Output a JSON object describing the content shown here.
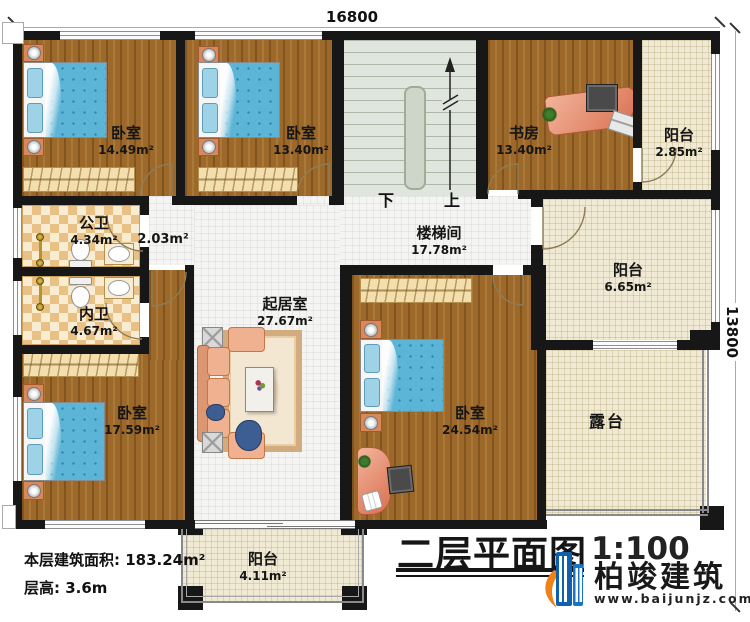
{
  "dimensions": {
    "top_width": "16800",
    "right_height": "13800"
  },
  "stairs": {
    "down": "下",
    "up": "上"
  },
  "rooms": {
    "bedroom_top_left": {
      "label": "卧室",
      "area": "14.49m²"
    },
    "bedroom_top_mid": {
      "label": "卧室",
      "area": "13.40m²"
    },
    "study": {
      "label": "书房",
      "area": "13.40m²"
    },
    "balcony_top_right": {
      "label": "阳台",
      "area": "2.85m²"
    },
    "public_bath": {
      "label": "公卫",
      "area": "4.34m²"
    },
    "hallway": {
      "area": "2.03m²"
    },
    "private_bath": {
      "label": "内卫",
      "area": "4.67m²"
    },
    "stairwell": {
      "label": "楼梯间",
      "area": "17.78m²"
    },
    "bedroom_bottom_left": {
      "label": "卧室",
      "area": "17.59m²"
    },
    "living_room": {
      "label": "起居室",
      "area": "27.67m²"
    },
    "bedroom_bottom_right": {
      "label": "卧室",
      "area": "24.54m²"
    },
    "balcony_right": {
      "label": "阳台",
      "area": "6.65m²"
    },
    "terrace": {
      "label": "露台"
    },
    "balcony_bottom": {
      "label": "阳台",
      "area": "4.11m²"
    }
  },
  "info": {
    "floor_area_label": "本层建筑面积:",
    "floor_area_value": "183.24m²",
    "floor_height_label": "层高:",
    "floor_height_value": "3.6m"
  },
  "title_block": {
    "title": "二层平面图",
    "scale": "1:100"
  },
  "brand": {
    "name": "柏竣建筑",
    "website": "www.baijunjz.com",
    "blue": "#1463ae",
    "orange": "#ee8118"
  }
}
